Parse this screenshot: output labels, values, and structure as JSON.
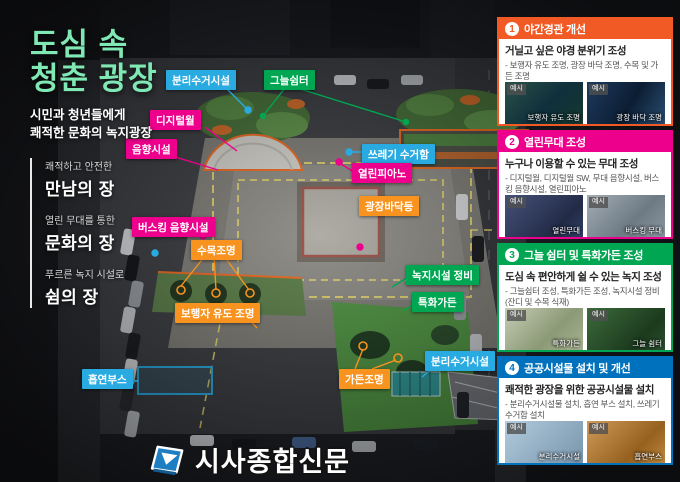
{
  "header": {
    "title_line1": "도심 속",
    "title_line2": "청춘 광장",
    "subtitle_line1": "시민과 청년들에게",
    "subtitle_line2": "쾌적한 문화의 녹지광장",
    "title_color": "#7fe8b4",
    "values": [
      {
        "small": "쾌적하고 안전한",
        "big": "만남의 장"
      },
      {
        "small": "열린 무대를 통한",
        "big": "문화의 장"
      },
      {
        "small": "푸르른 녹지 시설로",
        "big": "쉼의 장"
      }
    ]
  },
  "map": {
    "labels": [
      {
        "text": "분리수거시설",
        "color": "#29abe2"
      },
      {
        "text": "그늘쉼터",
        "color": "#00a651"
      },
      {
        "text": "디지털월",
        "color": "#ec008c"
      },
      {
        "text": "음향시설",
        "color": "#ec008c"
      },
      {
        "text": "쓰레기 수거함",
        "color": "#29abe2"
      },
      {
        "text": "열린피아노",
        "color": "#ec008c"
      },
      {
        "text": "광장바닥등",
        "color": "#f7931e"
      },
      {
        "text": "버스킹 음향시설",
        "color": "#ec008c"
      },
      {
        "text": "수목조명",
        "color": "#f7931e"
      },
      {
        "text": "보행자 유도 조명",
        "color": "#f7931e"
      },
      {
        "text": "녹지시설 정비",
        "color": "#00a651"
      },
      {
        "text": "특화가든",
        "color": "#00a651"
      },
      {
        "text": "분리수거시설",
        "color": "#29abe2"
      },
      {
        "text": "가든조명",
        "color": "#f7931e"
      },
      {
        "text": "흡연부스",
        "color": "#29abe2"
      }
    ]
  },
  "sidebar": {
    "photo_tag": "예시",
    "sections": [
      {
        "number": "1",
        "header": "야간경관 개선",
        "color": "#f15a24",
        "title": "거닐고 싶은 야경 분위기 조성",
        "desc": "- 보행자 유도 조명, 광장 바닥 조명, 수목 및 가든 조명",
        "photos": [
          {
            "caption": "보행자 유도 조명"
          },
          {
            "caption": "광장 바닥 조명"
          }
        ]
      },
      {
        "number": "2",
        "header": "열린무대 조성",
        "color": "#ec008c",
        "title": "누구나 이용할 수 있는 무대 조성",
        "desc": "- 디지털월, 디지털월 SW, 무대 음향시설, 버스킹 음향시설, 열린피아노",
        "photos": [
          {
            "caption": "열린무대"
          },
          {
            "caption": "버스킹 무대"
          }
        ]
      },
      {
        "number": "3",
        "header": "그늘 쉼터 및 특화가든 조성",
        "color": "#00a651",
        "title": "도심 속 편안하게 쉴 수 있는 녹지 조성",
        "desc": "- 그늘쉼터 조성, 특화가든 조성, 녹지시설 정비 (잔디 및 수목 식재)",
        "photos": [
          {
            "caption": "특화가든"
          },
          {
            "caption": "그늘 쉼터"
          }
        ]
      },
      {
        "number": "4",
        "header": "공공시설물 설치 및 개선",
        "color": "#0071bc",
        "title": "쾌적한 광장을 위한 공공시설물 설치",
        "desc": "- 분리수거시설물 설치, 흡연 부스 설치, 쓰레기 수거함 설치",
        "photos": [
          {
            "caption": "분리수거시설"
          },
          {
            "caption": "흡연부스"
          }
        ]
      }
    ]
  },
  "footer": {
    "publisher": "시사종합신문"
  }
}
